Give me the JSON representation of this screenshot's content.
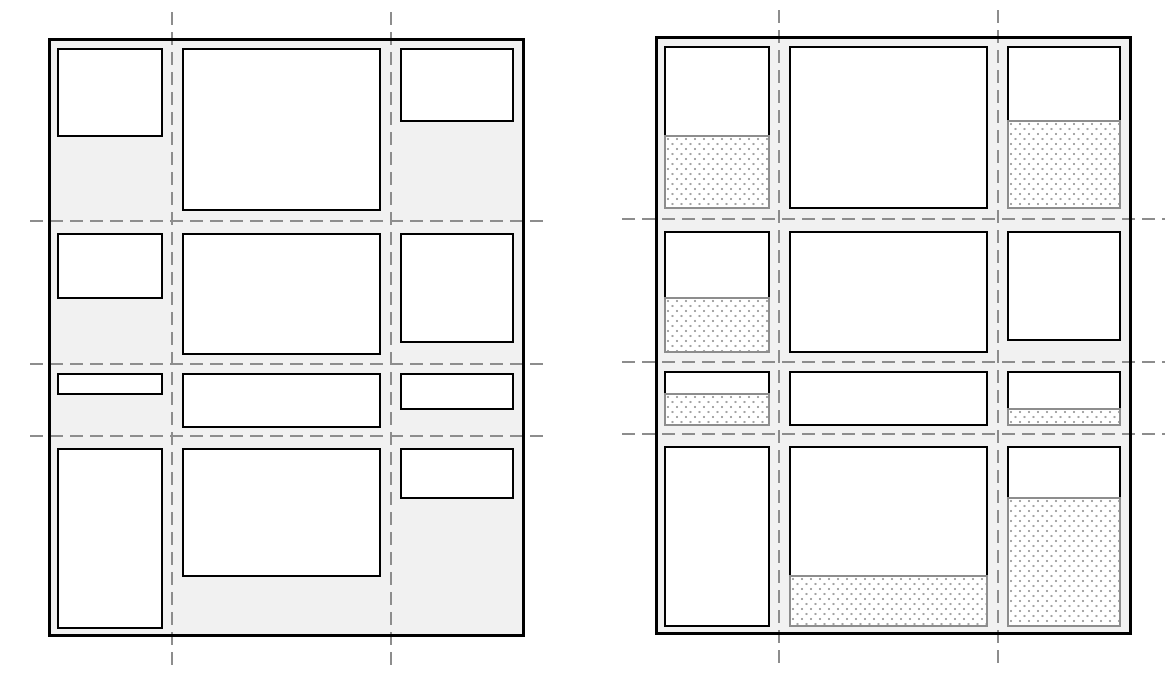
{
  "diagram": {
    "type": "grid-layout-schematic",
    "colors": {
      "page_bg": "#ffffff",
      "container_fill": "#f1f1f1",
      "container_border": "#000000",
      "item_fill": "#ffffff",
      "item_border": "#000000",
      "stretch_border": "#8d8d8d",
      "stretch_dots": "#a3a3a3",
      "gridline": "#8d8d8d"
    },
    "grid": {
      "width": 477,
      "height": 599,
      "col_lines": [
        124,
        343
      ],
      "row_lines": [
        183,
        326,
        398
      ],
      "col_content_x": [
        9,
        134,
        352
      ],
      "col_content_w": [
        106,
        199,
        114
      ],
      "row_content_y": [
        10,
        195,
        335,
        410
      ],
      "row_content_h": [
        163,
        122,
        55,
        181
      ],
      "vline_top": -26,
      "vline_bottom": 632
    },
    "panels": [
      {
        "id": "panel-1",
        "origin": {
          "x": 48,
          "y": 38
        },
        "hline_start": -18,
        "hline_end": 495,
        "items": [
          {
            "row": 0,
            "col": 0,
            "h": 89,
            "stretch": false
          },
          {
            "row": 0,
            "col": 1,
            "h": 163,
            "stretch": false
          },
          {
            "row": 0,
            "col": 2,
            "h": 74,
            "stretch": false
          },
          {
            "row": 1,
            "col": 0,
            "h": 66,
            "stretch": false
          },
          {
            "row": 1,
            "col": 1,
            "h": 122,
            "stretch": false
          },
          {
            "row": 1,
            "col": 2,
            "h": 110,
            "stretch": false
          },
          {
            "row": 2,
            "col": 0,
            "h": 22,
            "stretch": false
          },
          {
            "row": 2,
            "col": 1,
            "h": 55,
            "stretch": false
          },
          {
            "row": 2,
            "col": 2,
            "h": 37,
            "stretch": false
          },
          {
            "row": 3,
            "col": 0,
            "h": 181,
            "stretch": false
          },
          {
            "row": 3,
            "col": 1,
            "h": 129,
            "stretch": false
          },
          {
            "row": 3,
            "col": 2,
            "h": 51,
            "stretch": false
          }
        ]
      },
      {
        "id": "panel-2",
        "origin": {
          "x": 655,
          "y": 36
        },
        "hline_start": -33,
        "hline_end": 510,
        "items": [
          {
            "row": 0,
            "col": 0,
            "h": 89,
            "stretch": true
          },
          {
            "row": 0,
            "col": 1,
            "h": 163,
            "stretch": true
          },
          {
            "row": 0,
            "col": 2,
            "h": 74,
            "stretch": true
          },
          {
            "row": 1,
            "col": 0,
            "h": 66,
            "stretch": true
          },
          {
            "row": 1,
            "col": 1,
            "h": 122,
            "stretch": true
          },
          {
            "row": 1,
            "col": 2,
            "h": 110,
            "stretch": false
          },
          {
            "row": 2,
            "col": 0,
            "h": 22,
            "stretch": true
          },
          {
            "row": 2,
            "col": 1,
            "h": 55,
            "stretch": true
          },
          {
            "row": 2,
            "col": 2,
            "h": 37,
            "stretch": true
          },
          {
            "row": 3,
            "col": 0,
            "h": 181,
            "stretch": true
          },
          {
            "row": 3,
            "col": 1,
            "h": 129,
            "stretch": true
          },
          {
            "row": 3,
            "col": 2,
            "h": 51,
            "stretch": true
          }
        ]
      }
    ]
  }
}
